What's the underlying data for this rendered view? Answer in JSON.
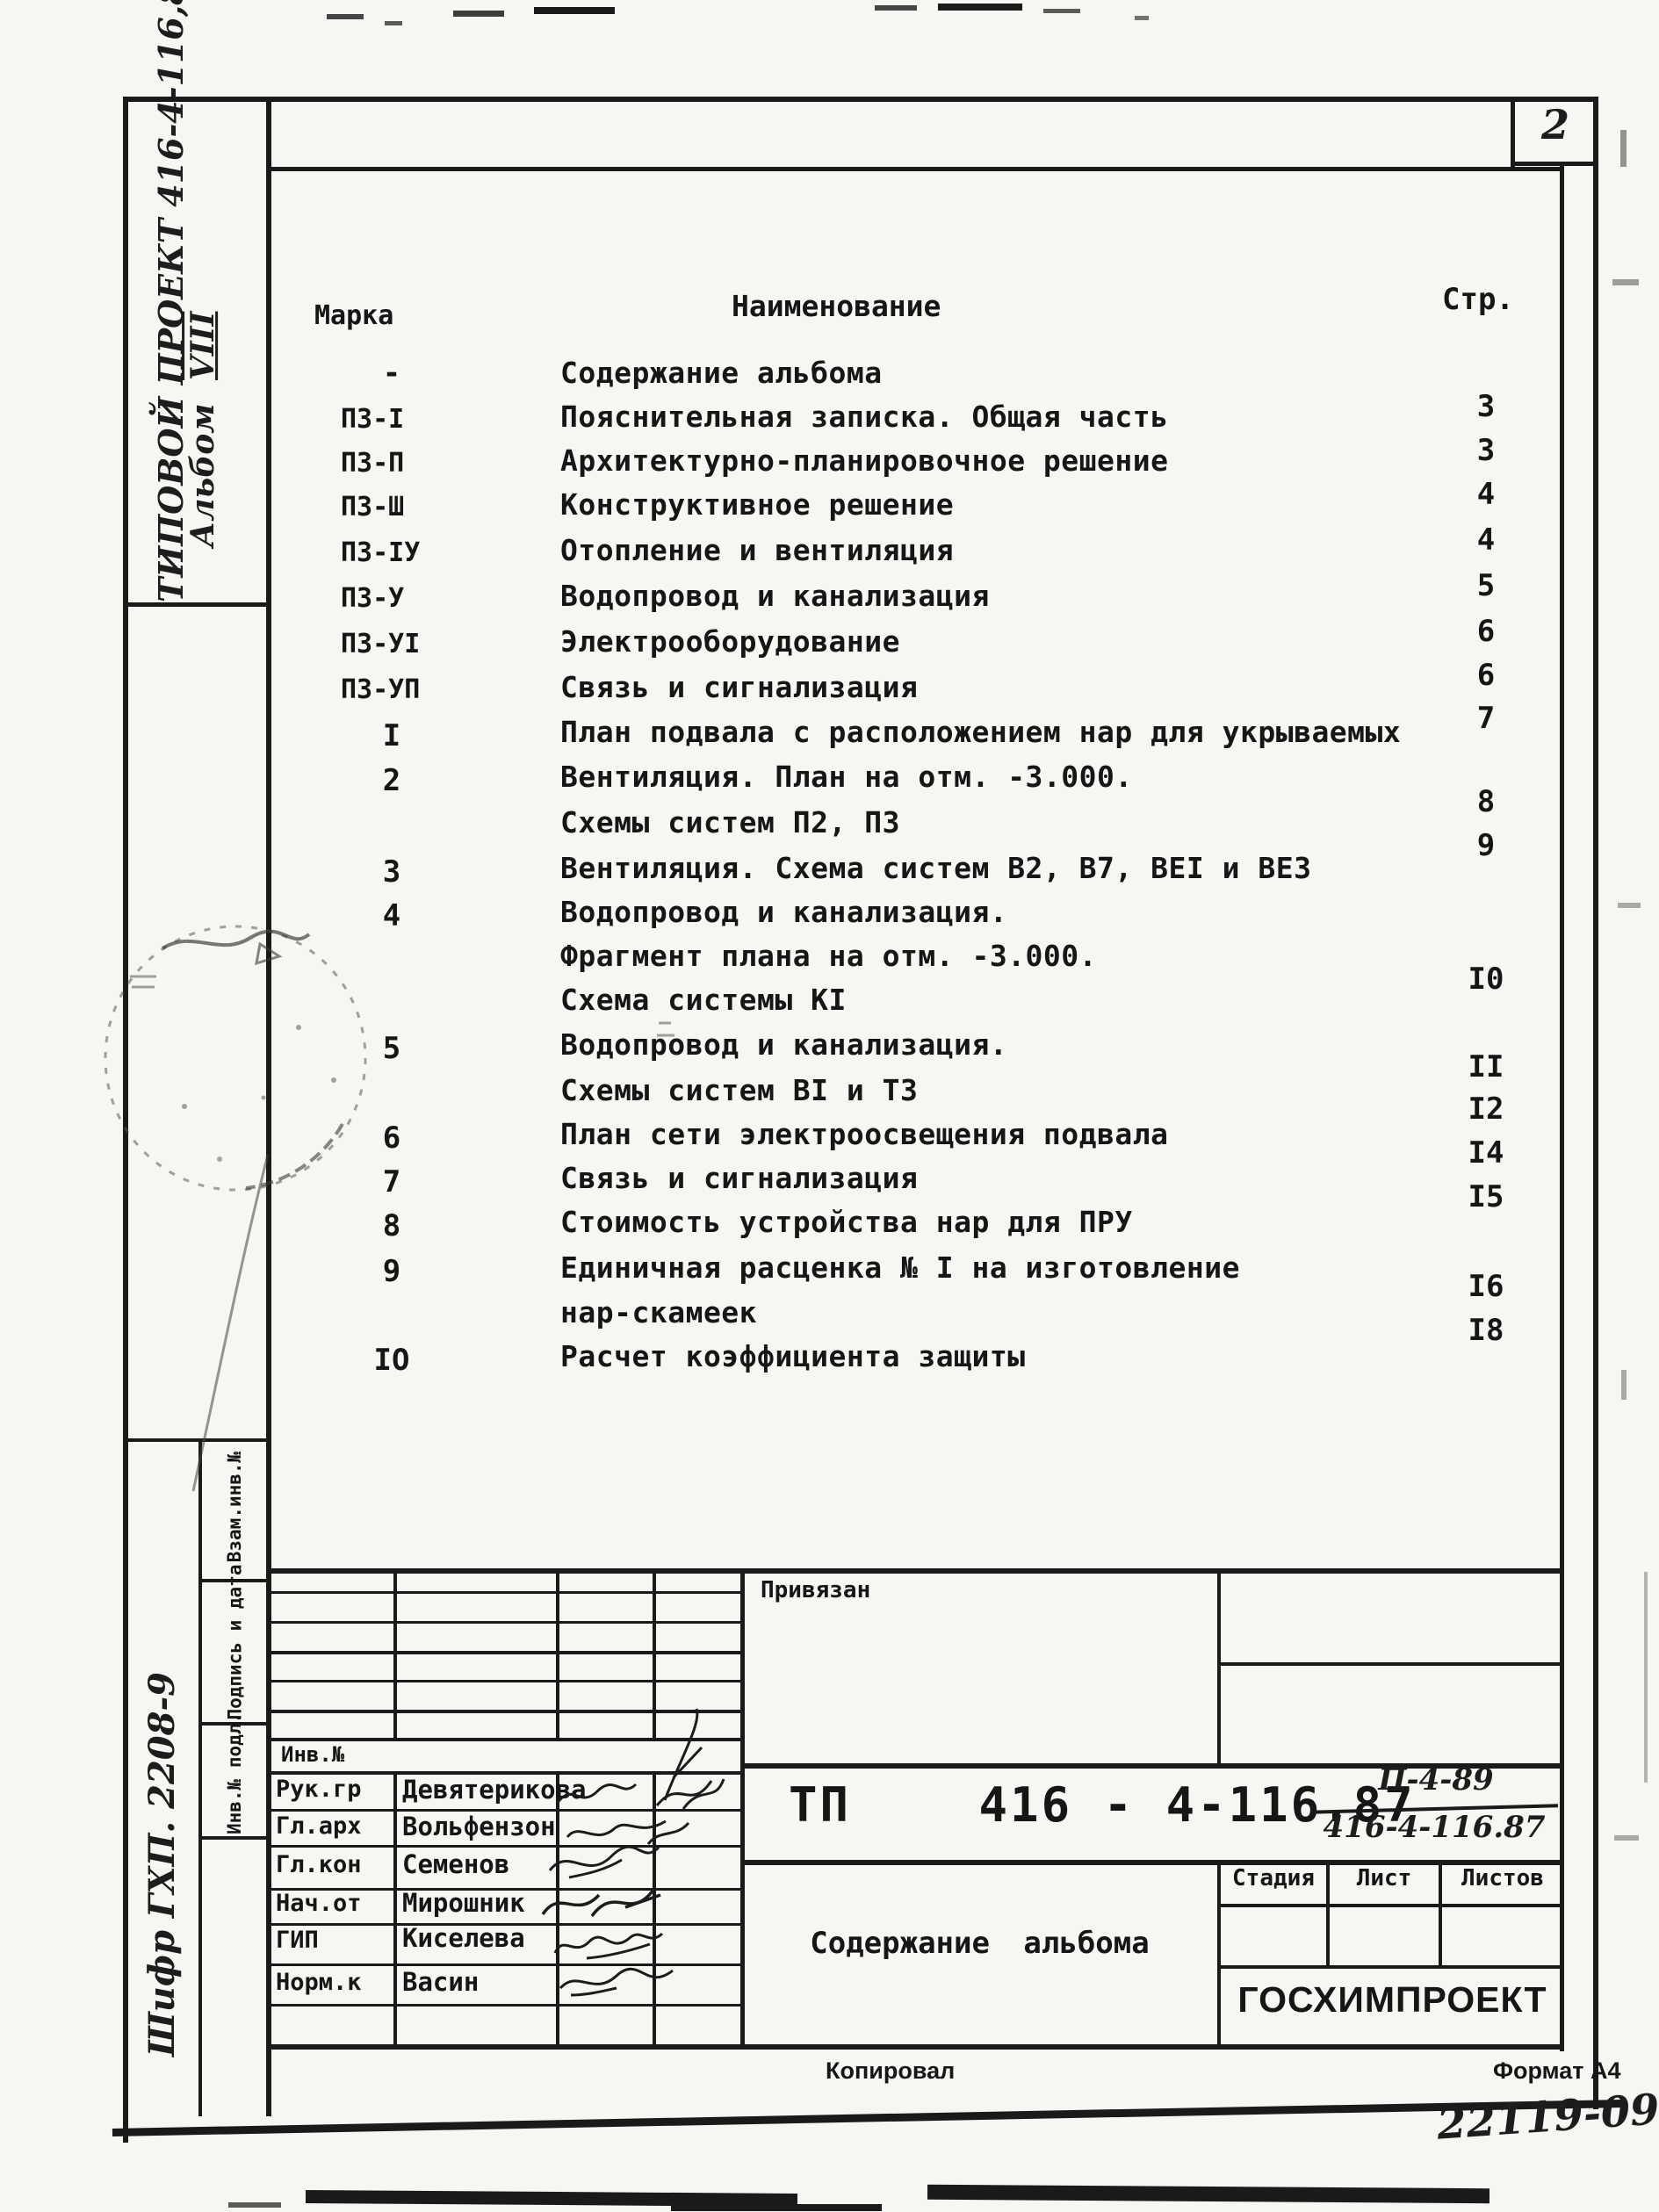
{
  "page": {
    "number": "2",
    "copied_label": "Копировал",
    "format_label": "Формат А4",
    "footer_code": "22119-09"
  },
  "side": {
    "project_line": "ТИПОВОЙ ПРОЕКТ 416-4-116,87",
    "album_label": "Альбом",
    "album_no": "VIII",
    "cipher": "Шифр ГХП. 2208-9",
    "vzam_label": "Взам.инв.№",
    "podpis_label": "Подпись и дата",
    "inv_podl_label": "Инв.№ подл."
  },
  "toc": {
    "headers": {
      "marka": "Марка",
      "name": "Наименование",
      "page": "Стр."
    },
    "rows": [
      {
        "marka": "-",
        "name": "Содержание альбома",
        "page": ""
      },
      {
        "marka": "ПЗ-I",
        "name": "Пояснительная записка. Общая часть",
        "page": "3"
      },
      {
        "marka": "ПЗ-П",
        "name": "Архитектурно-планировочное решение",
        "page": "3"
      },
      {
        "marka": "ПЗ-Ш",
        "name": "Конструктивное решение",
        "page": "4"
      },
      {
        "marka": "ПЗ-IУ",
        "name": "Отопление и вентиляция",
        "page": "4"
      },
      {
        "marka": "ПЗ-У",
        "name": "Водопровод и канализация",
        "page": "5"
      },
      {
        "marka": "ПЗ-УI",
        "name": "Электрооборудование",
        "page": "6"
      },
      {
        "marka": "ПЗ-УП",
        "name": "Связь и сигнализация",
        "page": "6"
      },
      {
        "marka": "I",
        "name": "План подвала с расположением нар для укрываемых",
        "page": "7"
      },
      {
        "marka": "2",
        "name": "Вентиляция. План на отм. -3.000.",
        "page": ""
      },
      {
        "marka": "",
        "name": "Схемы систем П2, П3",
        "page": "8"
      },
      {
        "marka": "3",
        "name": "Вентиляция. Схема систем В2, В7, ВЕI и ВЕ3",
        "page": "9"
      },
      {
        "marka": "4",
        "name": "Водопровод и канализация.",
        "page": ""
      },
      {
        "marka": "",
        "name": "Фрагмент плана на отм. -3.000.",
        "page": ""
      },
      {
        "marka": "",
        "name": "Схема системы КI",
        "page": "I0"
      },
      {
        "marka": "5",
        "name": "Водопровод и канализация.",
        "page": ""
      },
      {
        "marka": "",
        "name": "Схемы систем ВI и Т3",
        "page": "II"
      },
      {
        "marka": "6",
        "name": "План сети электроосвещения подвала",
        "page": "I2"
      },
      {
        "marka": "7",
        "name": "Связь и сигнализация",
        "page": "I4"
      },
      {
        "marka": "8",
        "name": "Стоимость устройства нар для ПРУ",
        "page": "I5"
      },
      {
        "marka": "9",
        "name": "Единичная расценка № I на изготовление",
        "page": ""
      },
      {
        "marka": "",
        "name": "нар-скамеек",
        "page": "I6"
      },
      {
        "marka": "IО",
        "name": "Расчет коэффициента защиты",
        "page": "I8"
      }
    ]
  },
  "titleblock": {
    "privyazan": "Привязан",
    "inv_label": "Инв.№",
    "doc_prefix": "ТП",
    "doc_number": "416 - 4-116.87",
    "fraction_top": "П-4-89",
    "fraction_bottom": "416-4-116.87",
    "stage_label": "Стадия",
    "sheet_label": "Лист",
    "sheets_label": "Листов",
    "doc_title": "Содержание альбома",
    "org": "ГОСХИМПРОЕКТ",
    "sign_rows": [
      {
        "role": "Рук.гр",
        "name": "Девятерикова"
      },
      {
        "role": "Гл.арх",
        "name": "Вольфензон"
      },
      {
        "role": "Гл.кон",
        "name": "Семенов"
      },
      {
        "role": "Нач.от",
        "name": "Мирошник"
      },
      {
        "role": "ГИП",
        "name": "Киселева"
      },
      {
        "role": "Норм.к",
        "name": "Васин"
      }
    ]
  }
}
